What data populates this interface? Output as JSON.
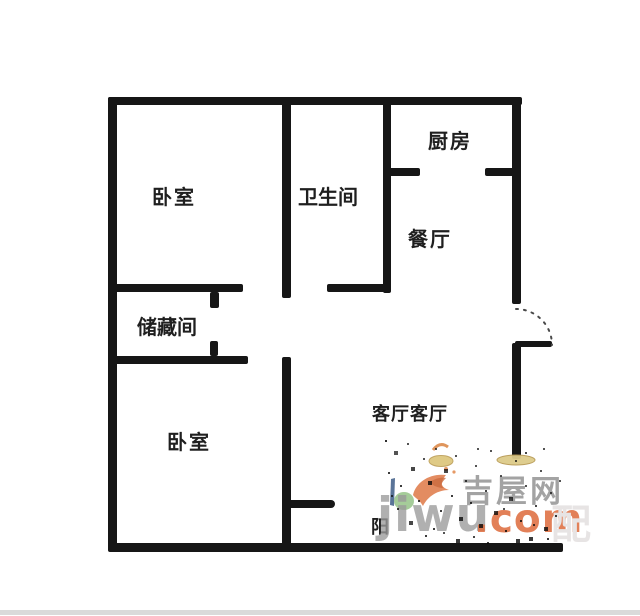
{
  "rooms": {
    "bedroom1": {
      "label": "卧室"
    },
    "bathroom": {
      "label": "卫生间"
    },
    "kitchen": {
      "label": "厨房"
    },
    "dining": {
      "label": "餐厅"
    },
    "storage": {
      "label": "储藏间"
    },
    "bedroom2": {
      "label": "卧室"
    },
    "living": {
      "label": "客厅客厅"
    },
    "balcony": {
      "label": "阳"
    }
  },
  "walls": [
    {
      "name": "top-wall",
      "x": 108,
      "y": 97,
      "w": 414,
      "h": 8
    },
    {
      "name": "left-wall",
      "x": 108,
      "y": 97,
      "w": 9,
      "h": 454
    },
    {
      "name": "bottom-wall",
      "x": 108,
      "y": 543,
      "w": 455,
      "h": 9
    },
    {
      "name": "right-wall-upper",
      "x": 512,
      "y": 97,
      "w": 9,
      "h": 207
    },
    {
      "name": "right-wall-lower",
      "x": 512,
      "y": 343,
      "w": 9,
      "h": 116
    },
    {
      "name": "bedroom1-bathroom-wall",
      "x": 282,
      "y": 97,
      "w": 9,
      "h": 201
    },
    {
      "name": "bathroom-kitchen-wall",
      "x": 383,
      "y": 97,
      "w": 8,
      "h": 196
    },
    {
      "name": "bathroom-south-wall",
      "x": 327,
      "y": 284,
      "w": 64,
      "h": 8
    },
    {
      "name": "kitchen-south-wall-left",
      "x": 383,
      "y": 168,
      "w": 37,
      "h": 8
    },
    {
      "name": "kitchen-south-wall-right",
      "x": 485,
      "y": 168,
      "w": 36,
      "h": 8
    },
    {
      "name": "storage-north-wall",
      "x": 108,
      "y": 284,
      "w": 135,
      "h": 8
    },
    {
      "name": "storage-north-door-jamb",
      "x": 210,
      "y": 292,
      "w": 9,
      "h": 16
    },
    {
      "name": "storage-south-wall",
      "x": 108,
      "y": 356,
      "w": 140,
      "h": 8
    },
    {
      "name": "storage-south-door-jamb",
      "x": 210,
      "y": 341,
      "w": 8,
      "h": 15
    },
    {
      "name": "bedroom2-living-wall",
      "x": 282,
      "y": 357,
      "w": 9,
      "h": 191
    },
    {
      "name": "balcony-door-jamb",
      "x": 291,
      "y": 500,
      "w": 44,
      "h": 8,
      "r": "0 8px 8px 0"
    },
    {
      "name": "entry-door-leaf",
      "x": 515,
      "y": 341,
      "w": 37,
      "h": 6
    }
  ],
  "watermark": {
    "brand_latin": "jiwu",
    "brand_tld": ".com",
    "brand_cn": "吉屋网",
    "outline_char": "配",
    "color_gray": "#9a9a9a",
    "color_orange": "#dd6b3c"
  }
}
